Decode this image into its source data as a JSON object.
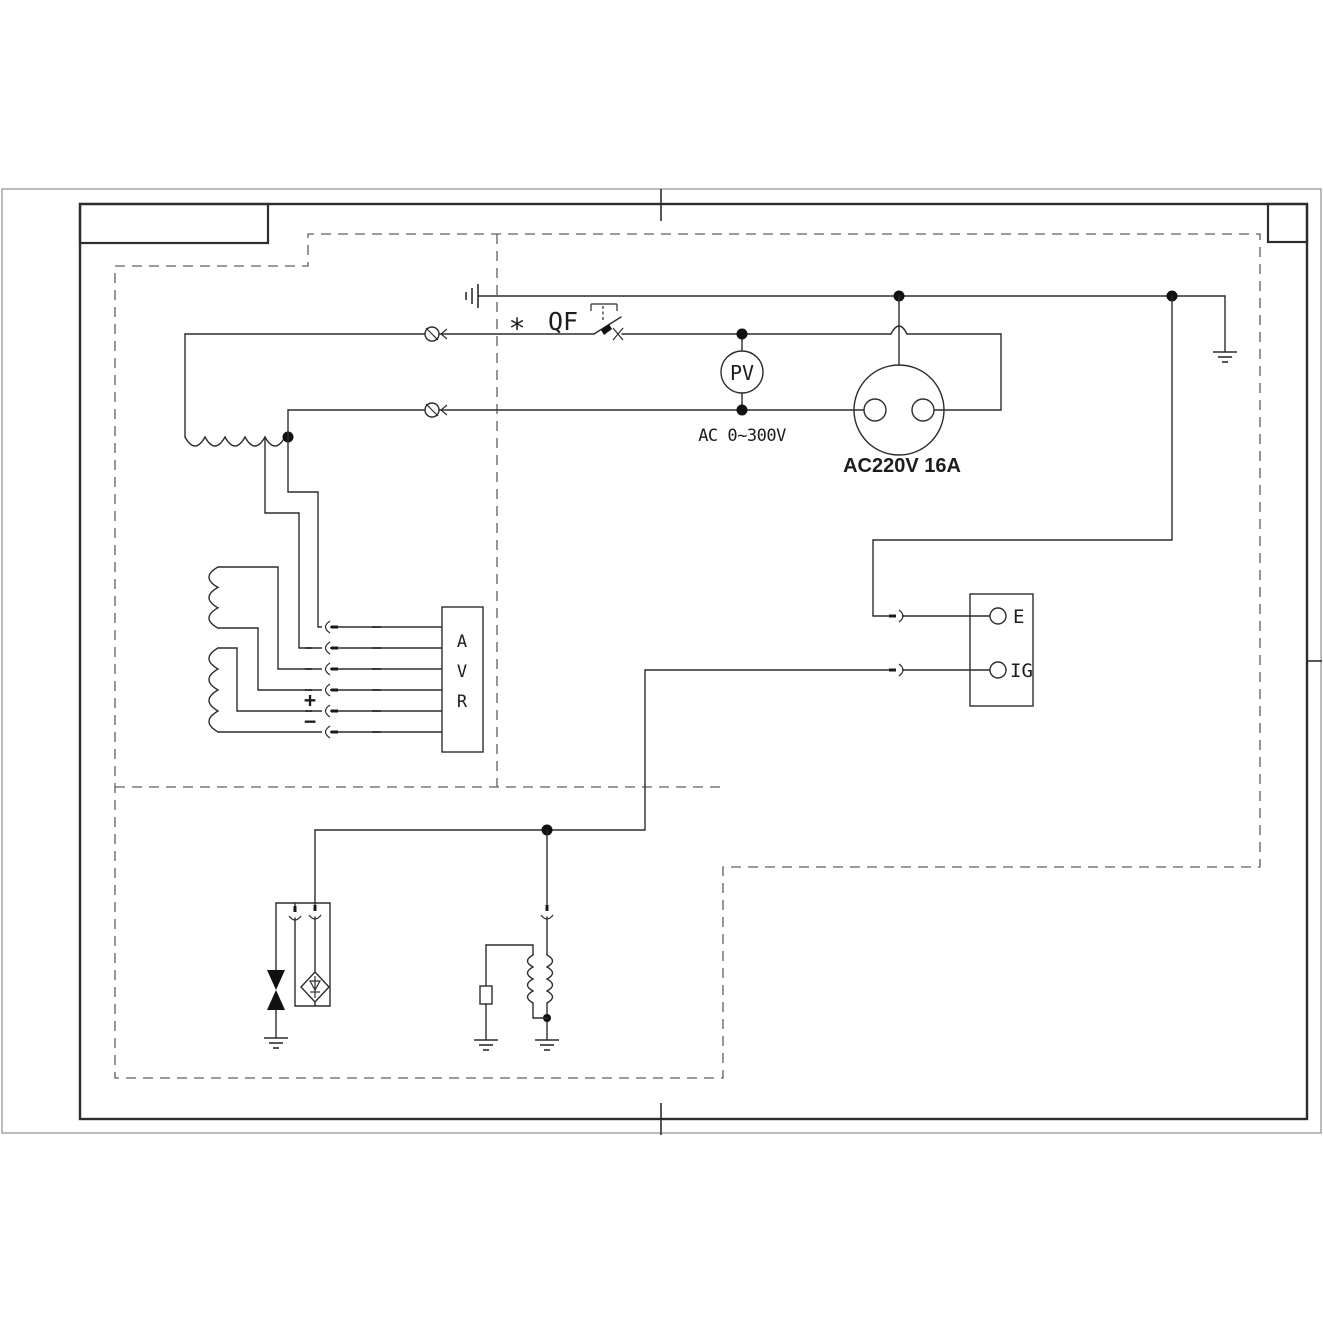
{
  "colors": {
    "background": "#ffffff",
    "ink": "#2d2d2d",
    "outer_border": "#8f8f8f",
    "dashed_boundary": "#5f5f5f"
  },
  "labels": {
    "breaker_star": "*",
    "breaker": "QF",
    "voltmeter": "PV",
    "voltmeter_range": "AC 0~300V",
    "socket_rating": "AC220V 16A",
    "avr_letters": [
      "A",
      "V",
      "R"
    ],
    "terminal_e": "E",
    "terminal_ig": "IG",
    "polarity_plus": "+",
    "polarity_minus": "−"
  },
  "icons": {
    "earth-ground-icon": "3-bar ground symbol",
    "chassis-ground-icon": "3-bar vertical ground symbol",
    "plug-connector-icon": "circle with slash",
    "inline-connector-icon": "arc socket with pin",
    "junction-dot-icon": "filled dot",
    "breaker-icon": "switch blade with trip link",
    "socket-icon": "circle with two pin holes",
    "winding-icon": "scalloped coil",
    "diode-icon": "triangle with bar in diamond",
    "bidirectional-diode-icon": "two facing filled triangles",
    "fuse-icon": "small rectangle on wire"
  }
}
